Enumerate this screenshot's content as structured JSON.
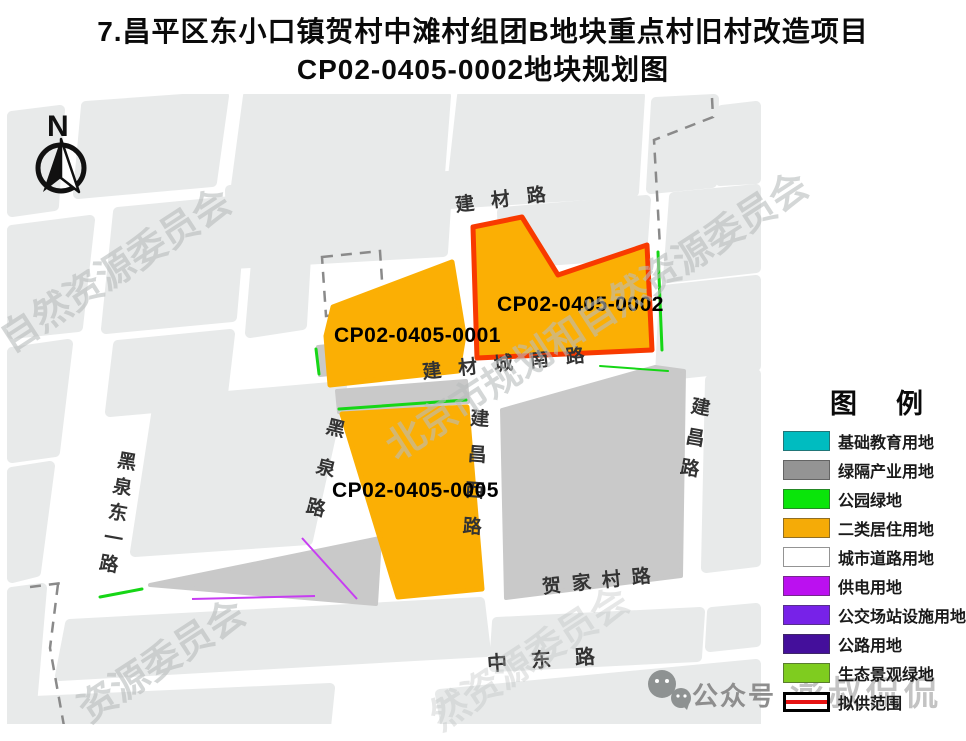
{
  "title": {
    "line1": "7.昌平区东小口镇贺村中滩村组团B地块重点村旧村改造项目",
    "line2": "CP02-0405-0002地块规划图"
  },
  "compass": {
    "label": "N"
  },
  "parcels": {
    "p1": {
      "id": "CP02-0405-0001"
    },
    "p2": {
      "id": "CP02-0405-0002"
    },
    "p5": {
      "id": "CP02-0405-0005"
    }
  },
  "roads": {
    "jiancai": "建材路",
    "jiancai_cheng_nan": "建材城南路",
    "jianchang_xi": "建昌西路",
    "jianchang": "建昌路",
    "heiquan": "黑泉路",
    "heiquan_dong_yi": "黑泉东一路",
    "hejiacun": "贺家村路",
    "zhongdong": "中东路"
  },
  "legend": {
    "title": "图　例",
    "items": [
      {
        "label": "基础教育用地",
        "color": "#00bcc0"
      },
      {
        "label": "绿隔产业用地",
        "color": "#949494"
      },
      {
        "label": "公园绿地",
        "color": "#0ae50a"
      },
      {
        "label": "二类居住用地",
        "color": "#f5ab07"
      },
      {
        "label": "城市道路用地",
        "color": "#ffffff"
      },
      {
        "label": "供电用地",
        "color": "#bb10f0"
      },
      {
        "label": "公交场站设施用地",
        "color": "#7722e8"
      },
      {
        "label": "公路用地",
        "color": "#440f9b"
      },
      {
        "label": "生态景观绿地",
        "color": "#7fcc1f"
      }
    ],
    "range_item": {
      "label": "拟供范围",
      "line_color": "#e61212"
    }
  },
  "watermarks": {
    "gov_full": "北京市规划和自然资源委员会",
    "gov_tail_left": "自然资源委员会",
    "gov_tail_bottom": "资源委员会",
    "gov_tail_bottom2": "然资源委员会",
    "wechat_label": "公众号",
    "account_name": "澎叔侃侃"
  },
  "colors": {
    "residential": "#fbaf04",
    "range_red": "#f83a00",
    "industry_gray": "#c9c9c9",
    "park_green": "#16d616",
    "power_magenta": "#c73df2"
  }
}
